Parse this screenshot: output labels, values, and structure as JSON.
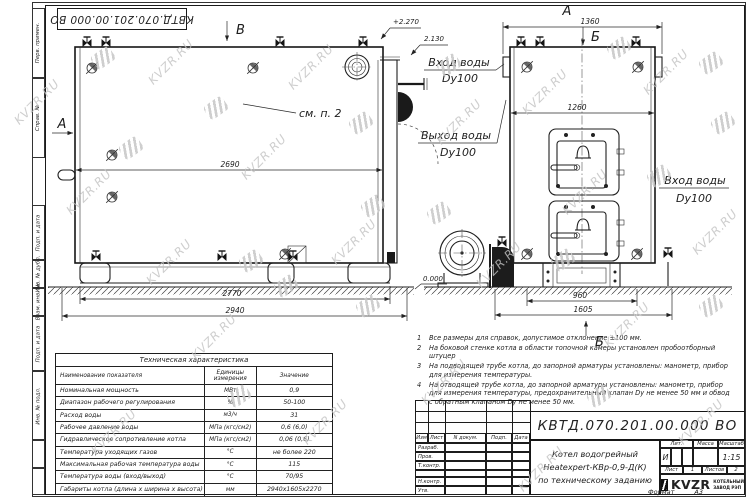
{
  "watermark": {
    "text": "KVZR.RU"
  },
  "margin": {
    "items": [
      "Перв. примен.",
      "Справ. №",
      "Подп. и дата",
      "Инв. № дубл.",
      "Взам. инв. №",
      "Подп. и дата",
      "Инв. № подл."
    ]
  },
  "drawing": {
    "view_label_a": "А",
    "section_a": "А",
    "section_v": "В",
    "section_b_top": "Б",
    "section_b_bottom": "Б",
    "elev_top": "+2.270",
    "elev_inlet": "2.130",
    "elev_ground": "0.000",
    "callout_see": "см. п. 2",
    "inlet_label": "Вход воды",
    "outlet_label": "Выход воды",
    "dn_label": "Dy100",
    "dims": {
      "boiler_top": "2690",
      "frame_len": "2770",
      "overall_len": "2940",
      "front_overall": "1360",
      "front_width": "1260",
      "base_width": "960",
      "front_frame": "1605"
    }
  },
  "tech_table": {
    "title": "Техническая характеристика",
    "headers": {
      "name": "Наименование показателя",
      "units": "Единицы измерения",
      "value": "Значение"
    },
    "rows": [
      {
        "name": "Номинальная мощность",
        "units": "МВт",
        "value": "0,9"
      },
      {
        "name": "Диапазон рабочего регулирования",
        "units": "%",
        "value": "50-100"
      },
      {
        "name": "Расход воды",
        "units": "м3/ч",
        "value": "31"
      },
      {
        "name": "Рабочее давление воды",
        "units": "МПа (кгс/см2)",
        "value": "0,6 (6,0)"
      },
      {
        "name": "Гидравлическое сопротивление котла",
        "units": "МПа (кгс/см2)",
        "value": "0,06 (0,6)"
      },
      {
        "name": "Температура уходящих газов",
        "units": "°С",
        "value": "не более 220"
      },
      {
        "name": "Максимальная рабочая температура воды",
        "units": "°С",
        "value": "115"
      },
      {
        "name": "Температура воды (вход/выход)",
        "units": "°С",
        "value": "70/95"
      },
      {
        "name": "Габариты котла (длина х ширина х высота)",
        "units": "мм",
        "value": "2940х1605х2270"
      }
    ]
  },
  "notes": [
    {
      "num": "1",
      "text": "Все размеры для справок, допустимое отклонение ±100 мм."
    },
    {
      "num": "2",
      "text": "На боковой стенке котла в области топочной камеры установлен пробоотборный штуцер"
    },
    {
      "num": "3",
      "text": "На подводящей трубе котла, до запорной арматуры установлены: манометр, прибор для измерения температуры."
    },
    {
      "num": "4",
      "text": "На отводящей трубе котла, до запорной арматуры установлены: манометр, прибор для измерения температуры, предохранительный клапан Dу не менее 50 мм и обвод с обратным клапаном Dу не менее 50 мм."
    }
  ],
  "title_block": {
    "doc_number": "КВТД.070.201.00.000  ВО",
    "header_cols": [
      "Изм",
      "Лист",
      "N докум.",
      "Подп.",
      "Дата"
    ],
    "sig_rows": [
      "Разраб.",
      "Пров.",
      "Т.контр.",
      "Н.контр.",
      "Утв."
    ],
    "title_line1": "Котел водогрейный",
    "title_line2": "Heatexpert-КВр-0,9-Д(К)",
    "title_line3": "по техническому заданию",
    "lit_header": "Лит.",
    "mass_header": "Масса",
    "scale_header": "Масштаб",
    "lit_value": "И",
    "scale_value": "1:15",
    "sheet_label": "Лист",
    "sheet_value": "1",
    "sheets_label": "Листов",
    "sheets_value": "2",
    "company_logo": "KVZR",
    "company_name1": "КОТЕЛЬНЫЙ",
    "company_name2": "ЗАВОД РЭП",
    "format_label": "Формат",
    "format_value": "А3"
  }
}
